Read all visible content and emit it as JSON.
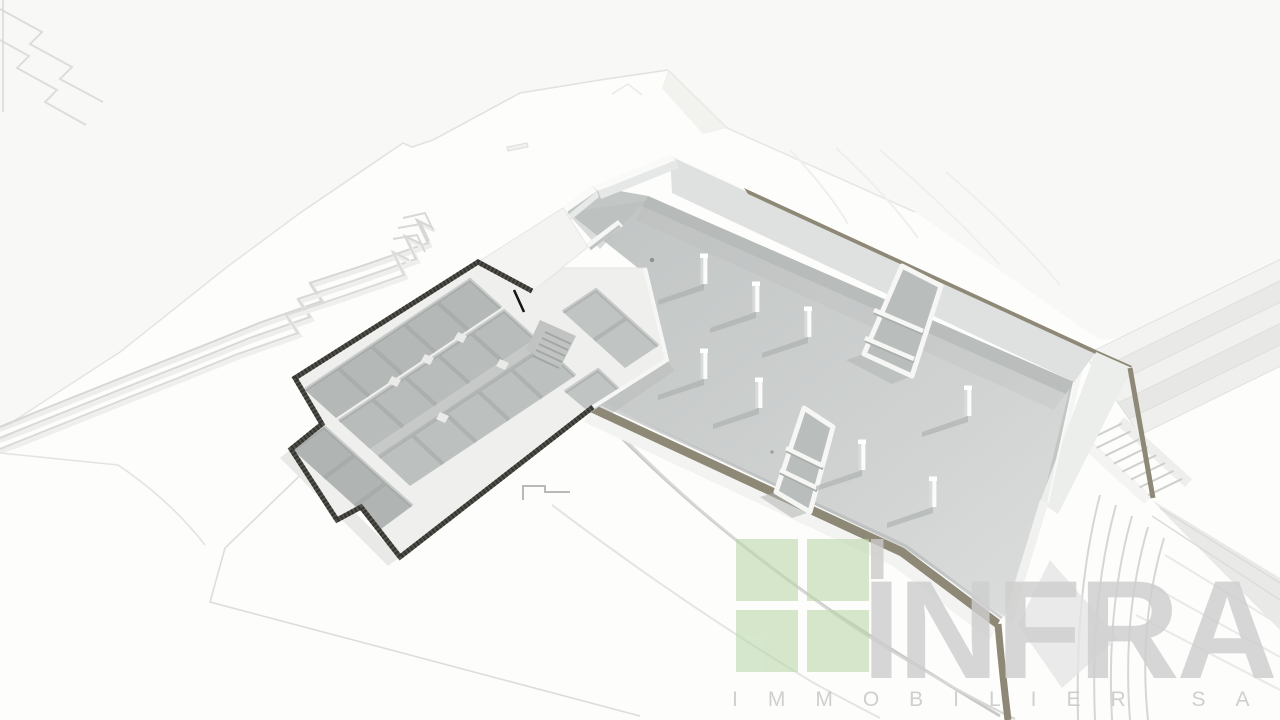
{
  "watermark": {
    "brand": "INFRA",
    "subtitle": "IMMOBILIER SA",
    "icon": "green-window-grid-icon"
  },
  "palette": {
    "accent_green": "#b9d7a9",
    "wall_cap_tan": "#8e8877",
    "floor_gray": "#cdd0cf",
    "floor_dark": "#b4b8b7",
    "wall_white": "#f2f2f0",
    "perimeter_band_dark": "#4e4d47",
    "terrain_white": "#f7f7f5"
  },
  "scene": {
    "type": "3d-architectural-render",
    "subject": "basement-level-floor-plan-with-parking-garage-and-cellar-rooms",
    "view": "aerial-oblique"
  }
}
